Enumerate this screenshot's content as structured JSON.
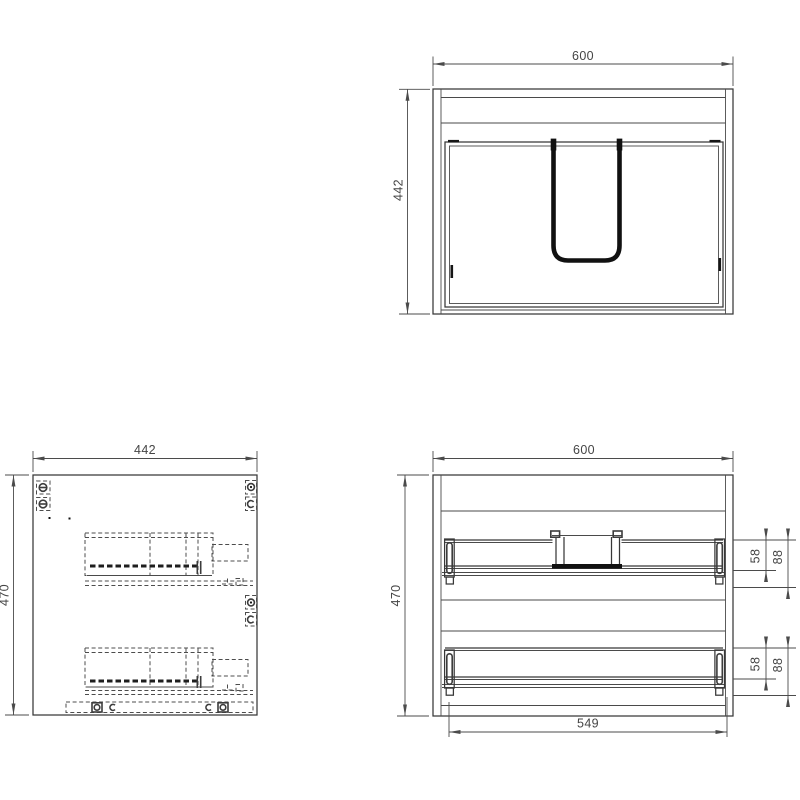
{
  "colors": {
    "background": "#ffffff",
    "object_line": "#383838",
    "dimension_line": "#4b4b4b"
  },
  "views": {
    "top": {
      "width": "600",
      "depth": "442"
    },
    "side": {
      "depth": "442",
      "height": "470"
    },
    "rear": {
      "width": "600",
      "height": "470",
      "drawer_span": "549",
      "upper_drawer": {
        "back_height": "58",
        "slide_height": "88"
      },
      "lower_drawer": {
        "back_height": "58",
        "slide_height": "88"
      }
    }
  }
}
